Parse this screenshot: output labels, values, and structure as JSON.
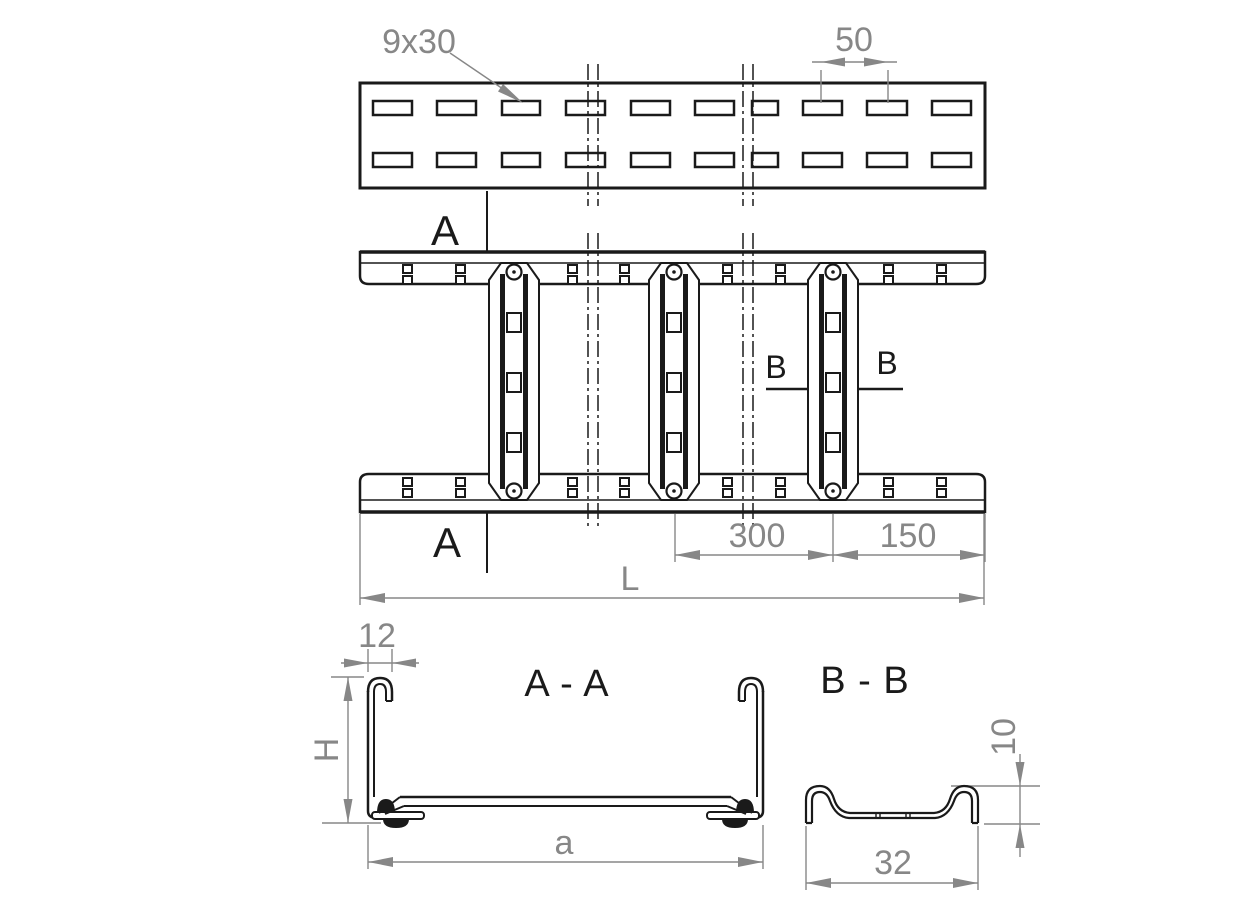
{
  "colors": {
    "line": "#1a1a1a",
    "dimension": "#878787",
    "background": "#ffffff"
  },
  "side_view": {
    "slot_label": "9x30",
    "pitch_dim": "50"
  },
  "plan_view": {
    "section_a_label": "A",
    "section_b_label": "B",
    "rung_spacing_dim": "300",
    "end_spacing_dim": "150",
    "length_dim": "L"
  },
  "section_aa": {
    "title": "A - A",
    "flange_dim": "12",
    "height_dim": "H",
    "width_dim": "a"
  },
  "section_bb": {
    "title": "B - B",
    "height_dim": "10",
    "width_dim": "32"
  }
}
